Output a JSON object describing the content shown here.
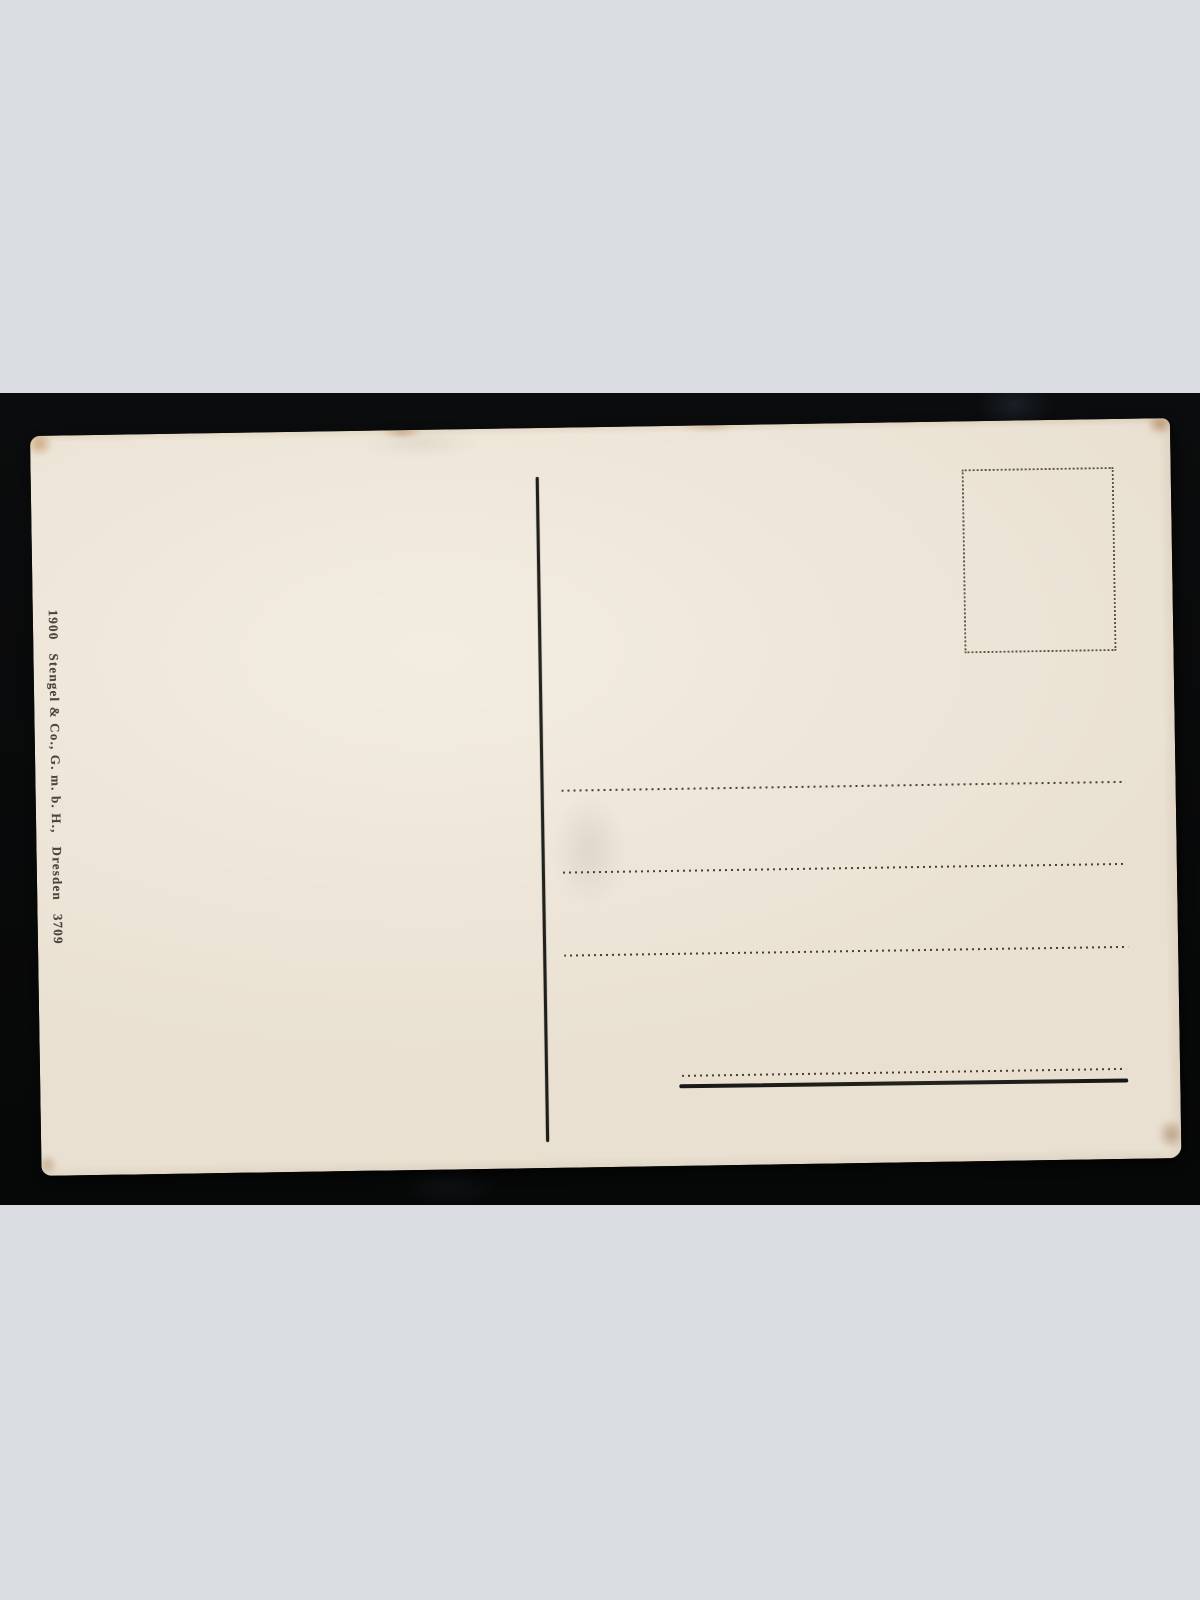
{
  "scene": {
    "kind": "scanned antique postcard back, blank, on black mat",
    "colors": {
      "page_background": "#d9dce1",
      "mat": "#0a0b0c",
      "card_paper": "#e9e0d1",
      "print_ink": "#3f3a30",
      "worn_edge_brown": "#b07840"
    }
  },
  "postcard": {
    "imprint": {
      "year": "1900",
      "publisher": "Stengel & Co., G. m. b. H.,",
      "city": "Dresden",
      "number": "3709"
    },
    "elements": {
      "stamp_box": "dotted-rectangle",
      "divider": "vertical-rule",
      "address_dotted_lines": 4,
      "address_base_line": 1
    }
  }
}
